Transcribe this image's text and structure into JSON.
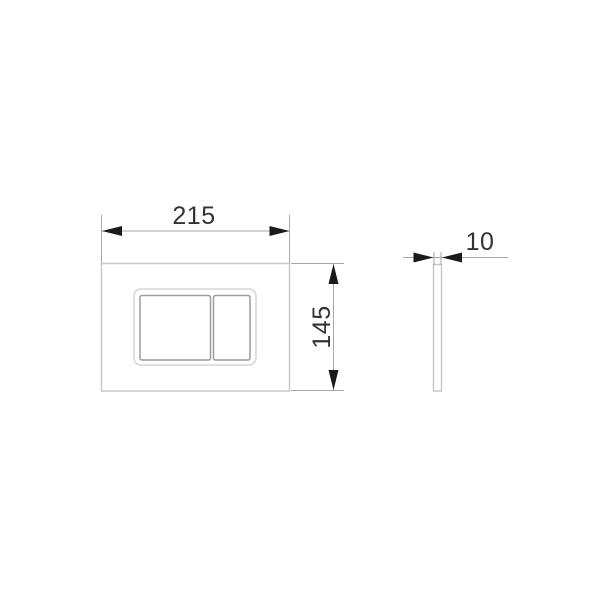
{
  "drawing": {
    "kind": "technical dimension drawing",
    "dimensions": {
      "width_label": "215",
      "height_label": "145",
      "depth_label": "10"
    },
    "colors": {
      "background": "#ffffff",
      "plate_outline": "#c9c9c9",
      "recess_outline": "#d6d6d6",
      "button_outline": "#9b9b9b",
      "dimension_line": "#a6a6a6",
      "arrow": "#1a1a1a",
      "text": "#333333"
    }
  }
}
